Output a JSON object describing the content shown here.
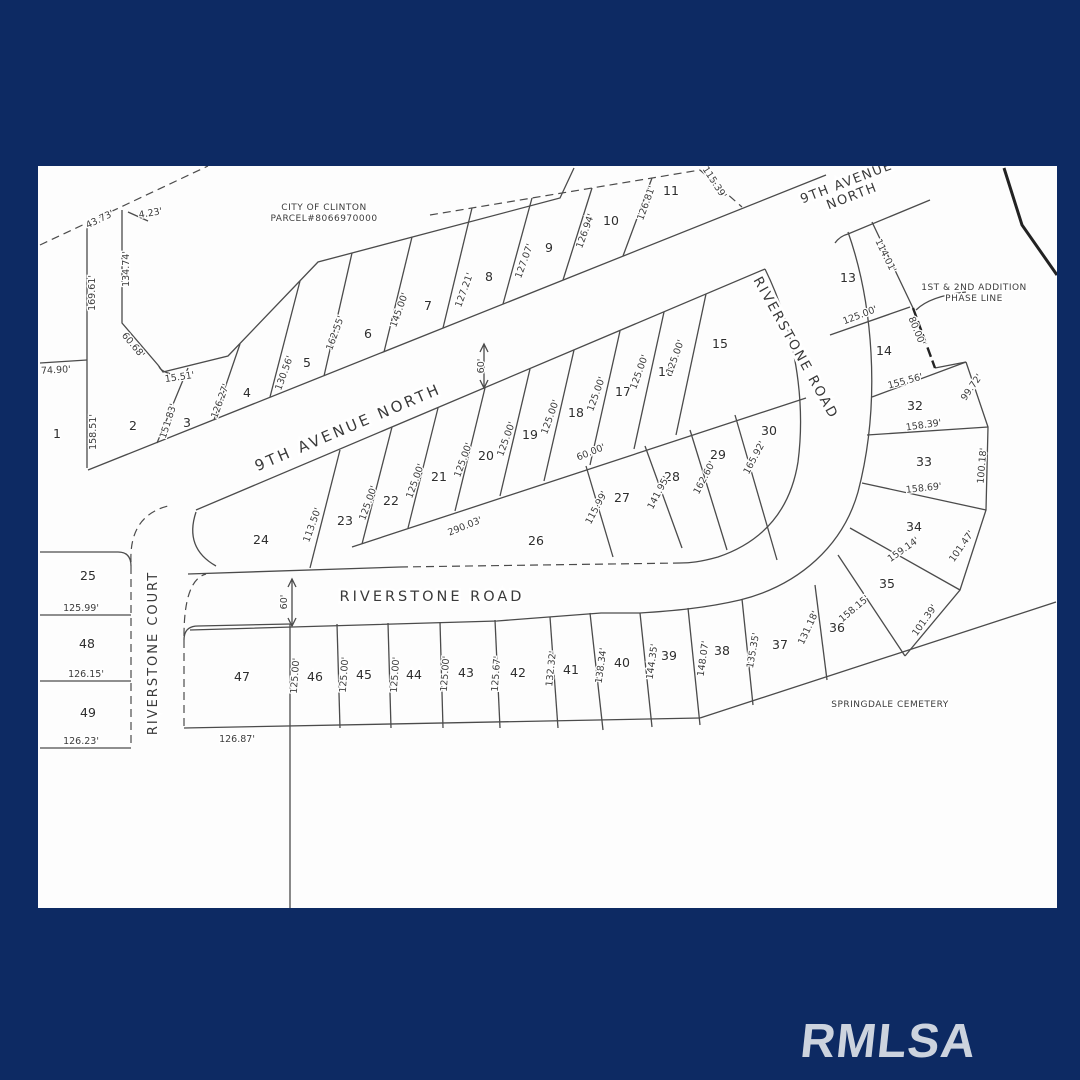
{
  "frame": {
    "background_color": "#0d2a63",
    "map_background": "#fdfdfd",
    "line_color": "#4b4b4b",
    "watermark": "RMLSA",
    "watermark_color": "#ccd3de"
  },
  "streets": [
    {
      "name": "9th-avenue-north-upper",
      "lines": [
        "9TH AVENUE",
        "NORTH"
      ],
      "x": 848,
      "y": 186,
      "rot": -21,
      "size": 13,
      "ls": 1.5
    },
    {
      "name": "9th-avenue-north",
      "lines": [
        "9TH AVENUE NORTH"
      ],
      "x": 350,
      "y": 432,
      "rot": -23,
      "size": 15,
      "ls": 3
    },
    {
      "name": "riverstone-road-curve",
      "lines": [
        "RIVERSTONE ROAD"
      ],
      "x": 792,
      "y": 350,
      "rot": 61,
      "size": 13.5,
      "ls": 2
    },
    {
      "name": "riverstone-road",
      "lines": [
        "RIVERSTONE ROAD"
      ],
      "x": 432,
      "y": 601,
      "rot": 0,
      "size": 14.5,
      "ls": 3
    },
    {
      "name": "riverstone-court",
      "lines": [
        "RIVERSTONE COURT"
      ],
      "x": 157,
      "y": 653,
      "rot": -90,
      "size": 13,
      "ls": 2
    }
  ],
  "annotations": [
    {
      "name": "city-parcel-note",
      "lines": [
        "CITY OF CLINTON",
        "PARCEL#8066970000"
      ],
      "x": 324,
      "y": 210
    },
    {
      "name": "phase-line-note",
      "lines": [
        "1ST & 2ND ADDITION",
        "PHASE LINE"
      ],
      "x": 974,
      "y": 290
    },
    {
      "name": "cemetery-note",
      "lines": [
        "SPRINGDALE CEMETERY"
      ],
      "x": 890,
      "y": 707
    }
  ],
  "lots": [
    {
      "n": "1",
      "x": 57,
      "y": 434
    },
    {
      "n": "2",
      "x": 133,
      "y": 426
    },
    {
      "n": "3",
      "x": 187,
      "y": 423
    },
    {
      "n": "4",
      "x": 247,
      "y": 393
    },
    {
      "n": "5",
      "x": 307,
      "y": 363
    },
    {
      "n": "6",
      "x": 368,
      "y": 334
    },
    {
      "n": "7",
      "x": 428,
      "y": 306
    },
    {
      "n": "8",
      "x": 489,
      "y": 277
    },
    {
      "n": "9",
      "x": 549,
      "y": 248
    },
    {
      "n": "10",
      "x": 611,
      "y": 221
    },
    {
      "n": "11",
      "x": 671,
      "y": 191
    },
    {
      "n": "13",
      "x": 848,
      "y": 278
    },
    {
      "n": "14",
      "x": 884,
      "y": 351
    },
    {
      "n": "15",
      "x": 720,
      "y": 344
    },
    {
      "n": "16",
      "x": 666,
      "y": 372
    },
    {
      "n": "17",
      "x": 623,
      "y": 392
    },
    {
      "n": "18",
      "x": 576,
      "y": 413
    },
    {
      "n": "19",
      "x": 530,
      "y": 435
    },
    {
      "n": "20",
      "x": 486,
      "y": 456
    },
    {
      "n": "21",
      "x": 439,
      "y": 477
    },
    {
      "n": "22",
      "x": 391,
      "y": 501
    },
    {
      "n": "23",
      "x": 345,
      "y": 521
    },
    {
      "n": "24",
      "x": 261,
      "y": 540
    },
    {
      "n": "25",
      "x": 88,
      "y": 576
    },
    {
      "n": "26",
      "x": 536,
      "y": 541
    },
    {
      "n": "27",
      "x": 622,
      "y": 498
    },
    {
      "n": "28",
      "x": 672,
      "y": 477
    },
    {
      "n": "29",
      "x": 718,
      "y": 455
    },
    {
      "n": "30",
      "x": 769,
      "y": 431
    },
    {
      "n": "32",
      "x": 915,
      "y": 406
    },
    {
      "n": "33",
      "x": 924,
      "y": 462
    },
    {
      "n": "34",
      "x": 914,
      "y": 527
    },
    {
      "n": "35",
      "x": 887,
      "y": 584
    },
    {
      "n": "36",
      "x": 837,
      "y": 628
    },
    {
      "n": "37",
      "x": 780,
      "y": 645
    },
    {
      "n": "38",
      "x": 722,
      "y": 651
    },
    {
      "n": "39",
      "x": 669,
      "y": 656
    },
    {
      "n": "40",
      "x": 622,
      "y": 663
    },
    {
      "n": "41",
      "x": 571,
      "y": 670
    },
    {
      "n": "42",
      "x": 518,
      "y": 673
    },
    {
      "n": "43",
      "x": 466,
      "y": 673
    },
    {
      "n": "44",
      "x": 414,
      "y": 675
    },
    {
      "n": "45",
      "x": 364,
      "y": 675
    },
    {
      "n": "46",
      "x": 315,
      "y": 677
    },
    {
      "n": "47",
      "x": 242,
      "y": 677
    },
    {
      "n": "48",
      "x": 87,
      "y": 644
    },
    {
      "n": "49",
      "x": 88,
      "y": 713
    }
  ],
  "dimensions": [
    {
      "t": "74.90'",
      "x": 56,
      "y": 373,
      "r": -3
    },
    {
      "t": "43.73'",
      "x": 101,
      "y": 222,
      "r": -26
    },
    {
      "t": "4.23'",
      "x": 151,
      "y": 216,
      "r": -10
    },
    {
      "t": "134.74'",
      "x": 129,
      "y": 269,
      "r": -90
    },
    {
      "t": "169.61'",
      "x": 95,
      "y": 293,
      "r": -90
    },
    {
      "t": "158.51'",
      "x": 96,
      "y": 432,
      "r": -90
    },
    {
      "t": "60.68'",
      "x": 131,
      "y": 347,
      "r": 50
    },
    {
      "t": "15.51'",
      "x": 180,
      "y": 380,
      "r": -8
    },
    {
      "t": "151.83'",
      "x": 171,
      "y": 422,
      "r": -72
    },
    {
      "t": "126.27'",
      "x": 223,
      "y": 402,
      "r": -70
    },
    {
      "t": "130.56'",
      "x": 287,
      "y": 374,
      "r": -70
    },
    {
      "t": "162.55'",
      "x": 338,
      "y": 334,
      "r": -70
    },
    {
      "t": "145.00'",
      "x": 402,
      "y": 311,
      "r": -70
    },
    {
      "t": "127.21'",
      "x": 467,
      "y": 291,
      "r": -70
    },
    {
      "t": "127.07'",
      "x": 527,
      "y": 262,
      "r": -70
    },
    {
      "t": "126.94'",
      "x": 588,
      "y": 232,
      "r": -70
    },
    {
      "t": "126.81'",
      "x": 649,
      "y": 204,
      "r": -70
    },
    {
      "t": "115.39'",
      "x": 712,
      "y": 184,
      "r": 57
    },
    {
      "t": "60'",
      "x": 484,
      "y": 366,
      "r": -90
    },
    {
      "t": "113.50'",
      "x": 315,
      "y": 526,
      "r": -70
    },
    {
      "t": "125.00'",
      "x": 371,
      "y": 504,
      "r": -70
    },
    {
      "t": "125.00'",
      "x": 418,
      "y": 482,
      "r": -70
    },
    {
      "t": "125.00'",
      "x": 466,
      "y": 461,
      "r": -70
    },
    {
      "t": "125.00'",
      "x": 509,
      "y": 440,
      "r": -70
    },
    {
      "t": "125.00'",
      "x": 553,
      "y": 418,
      "r": -70
    },
    {
      "t": "125.00'",
      "x": 599,
      "y": 395,
      "r": -70
    },
    {
      "t": "125.00'",
      "x": 642,
      "y": 373,
      "r": -70
    },
    {
      "t": "125.00'",
      "x": 678,
      "y": 358,
      "r": -70
    },
    {
      "t": "60.00'",
      "x": 592,
      "y": 455,
      "r": -22
    },
    {
      "t": "290.03'",
      "x": 466,
      "y": 529,
      "r": -22
    },
    {
      "t": "115.99'",
      "x": 599,
      "y": 509,
      "r": -62
    },
    {
      "t": "141.95'",
      "x": 661,
      "y": 494,
      "r": -62
    },
    {
      "t": "162.60'",
      "x": 707,
      "y": 479,
      "r": -62
    },
    {
      "t": "165.92'",
      "x": 757,
      "y": 459,
      "r": -62
    },
    {
      "t": "125.00'",
      "x": 861,
      "y": 318,
      "r": -21
    },
    {
      "t": "114.01'",
      "x": 883,
      "y": 257,
      "r": 64
    },
    {
      "t": "80.00'",
      "x": 914,
      "y": 332,
      "r": 68
    },
    {
      "t": "155.56'",
      "x": 906,
      "y": 384,
      "r": -15
    },
    {
      "t": "99.72'",
      "x": 974,
      "y": 389,
      "r": -55
    },
    {
      "t": "158.39'",
      "x": 924,
      "y": 428,
      "r": -8
    },
    {
      "t": "100.18'",
      "x": 985,
      "y": 466,
      "r": -85
    },
    {
      "t": "158.69'",
      "x": 924,
      "y": 491,
      "r": -6
    },
    {
      "t": "101.47'",
      "x": 964,
      "y": 548,
      "r": -55
    },
    {
      "t": "159.14'",
      "x": 905,
      "y": 552,
      "r": -35
    },
    {
      "t": "158.15'",
      "x": 856,
      "y": 611,
      "r": -40
    },
    {
      "t": "101.39'",
      "x": 927,
      "y": 622,
      "r": -55
    },
    {
      "t": "131.18'",
      "x": 811,
      "y": 629,
      "r": -65
    },
    {
      "t": "135.35'",
      "x": 756,
      "y": 651,
      "r": -80
    },
    {
      "t": "148.07'",
      "x": 706,
      "y": 659,
      "r": -82
    },
    {
      "t": "144.35'",
      "x": 655,
      "y": 662,
      "r": -82
    },
    {
      "t": "138.34'",
      "x": 604,
      "y": 666,
      "r": -82
    },
    {
      "t": "132.32'",
      "x": 554,
      "y": 669,
      "r": -84
    },
    {
      "t": "125.67'",
      "x": 499,
      "y": 674,
      "r": -86
    },
    {
      "t": "125.00'",
      "x": 448,
      "y": 674,
      "r": -86
    },
    {
      "t": "125.00'",
      "x": 398,
      "y": 675,
      "r": -86
    },
    {
      "t": "125.00'",
      "x": 347,
      "y": 675,
      "r": -86
    },
    {
      "t": "125.00'",
      "x": 298,
      "y": 676,
      "r": -86
    },
    {
      "t": "126.87'",
      "x": 237,
      "y": 742,
      "r": 0
    },
    {
      "t": "125.99'",
      "x": 81,
      "y": 611,
      "r": 0
    },
    {
      "t": "126.15'",
      "x": 86,
      "y": 677,
      "r": 0
    },
    {
      "t": "126.23'",
      "x": 81,
      "y": 744,
      "r": 0
    },
    {
      "t": "60'",
      "x": 287,
      "y": 602,
      "r": -90
    }
  ]
}
